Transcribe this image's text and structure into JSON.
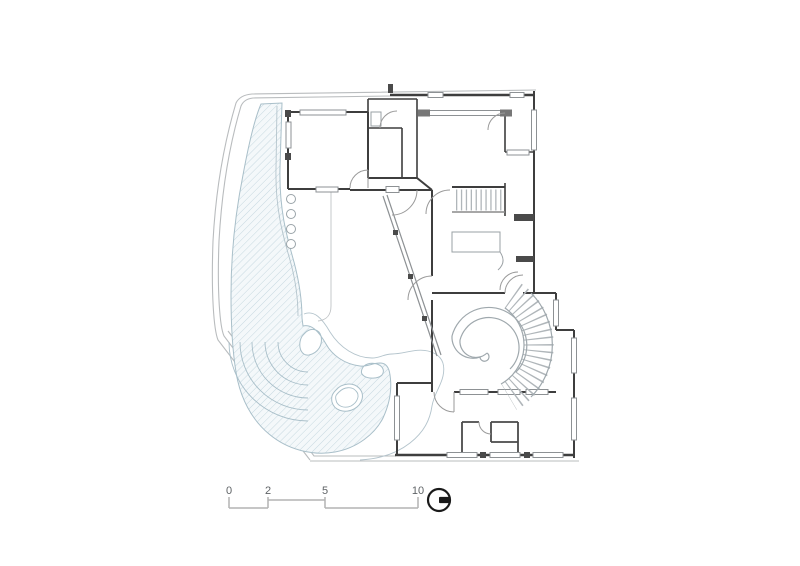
{
  "drawing": {
    "type": "architectural-ground-floor-plan",
    "scale_bar": {
      "labels": [
        "0",
        "2",
        "5",
        "10"
      ]
    },
    "north_indicator": {
      "icon": "north-orientation-icon"
    },
    "colors": {
      "background": "#ffffff",
      "wall_line": "#3e3e3e",
      "light_line": "#b9bcbe",
      "hatch_line": "#c6d8e0",
      "hatch_fill": "#f4f8fa",
      "window_line": "#8d9194",
      "stair_line": "#b0b6ba",
      "label_text": "#5f6366",
      "north_symbol": "#1a1a1a"
    }
  }
}
